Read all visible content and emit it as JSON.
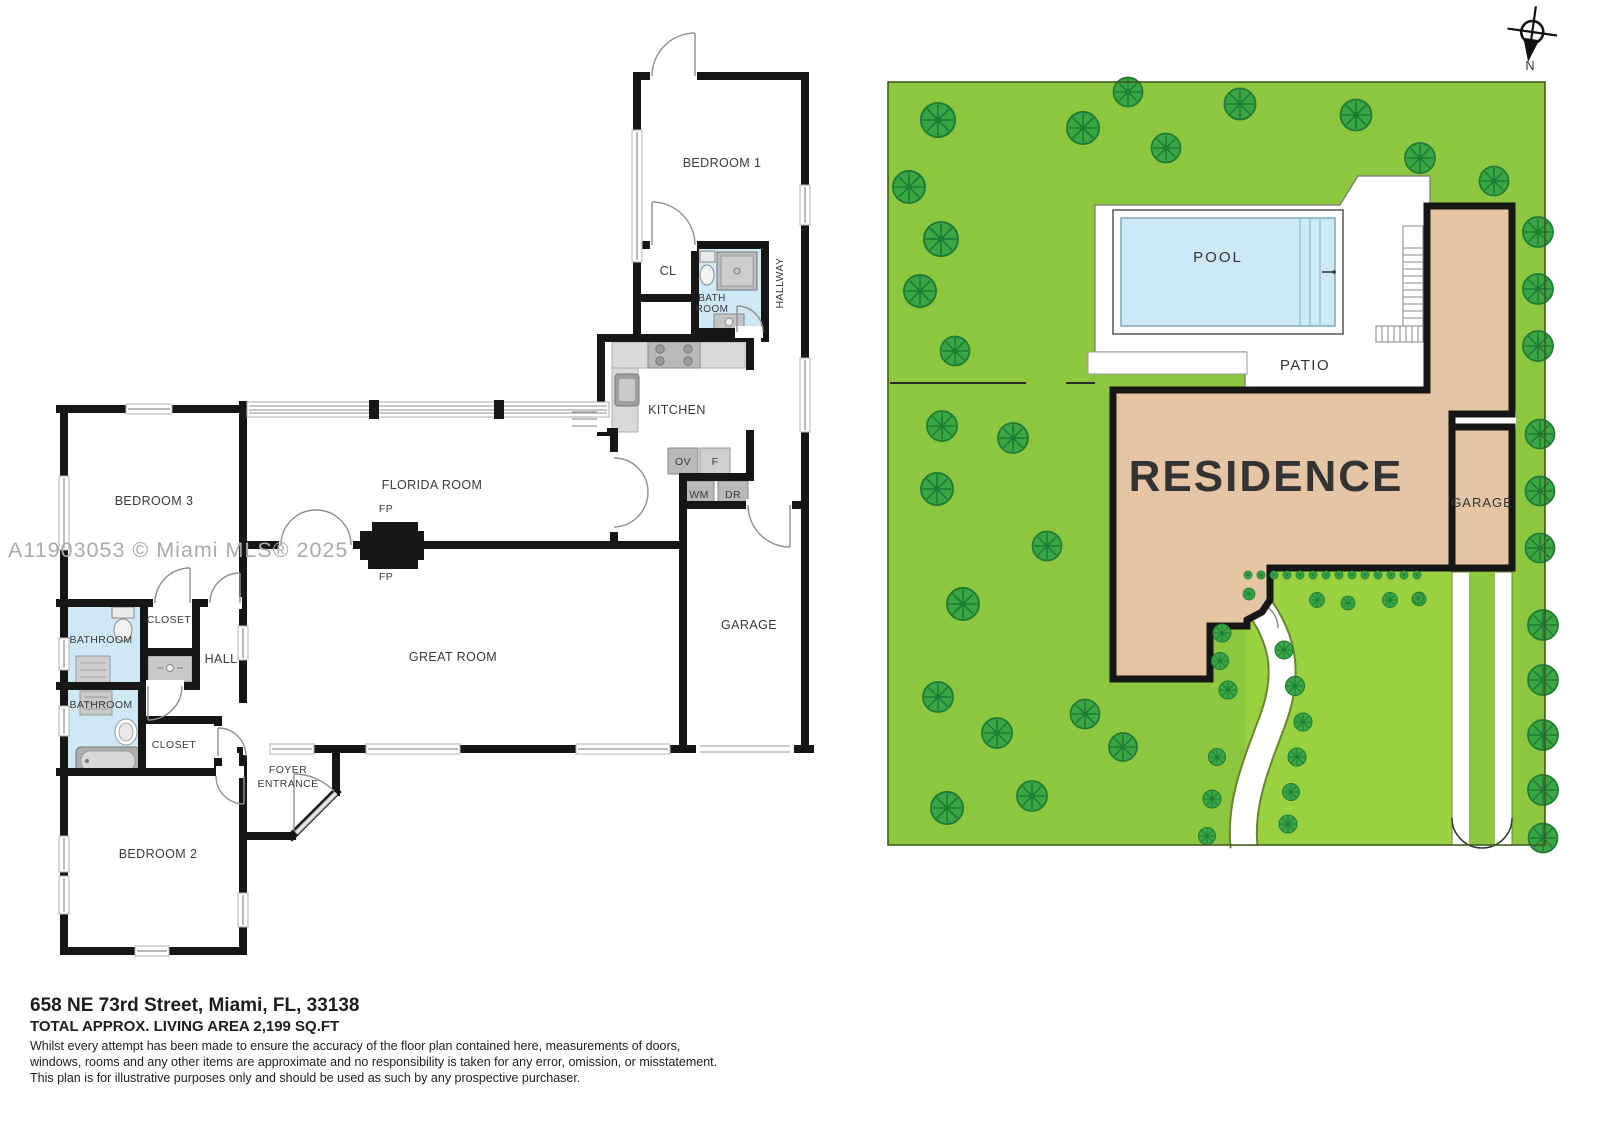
{
  "watermark": "A11903053 © Miami MLS® 2025",
  "compass_label": "N",
  "floor_plan": {
    "bedroom1": "BEDROOM 1",
    "cl": "CL",
    "bath_line1": "BATH",
    "bath_line2": "ROOM",
    "hallway": "HALLWAY",
    "kitchen": "KITCHEN",
    "ov": "OV",
    "fridge": "F",
    "wm": "WM",
    "dr": "DR",
    "florida_room": "FLORIDA ROOM",
    "fp": "FP",
    "bedroom3": "BEDROOM 3",
    "bathroom_top": "BATHROOM",
    "closet_top": "CLOSET",
    "hall": "HALL",
    "bathroom_bottom": "BATHROOM",
    "closet_bottom": "CLOSET",
    "great_room": "GREAT ROOM",
    "garage": "GARAGE",
    "foyer_line1": "FOYER",
    "foyer_line2": "ENTRANCE",
    "bedroom2": "BEDROOM 2"
  },
  "site_plan": {
    "pool": "POOL",
    "patio": "PATIO",
    "residence": "RESIDENCE",
    "garage": "GARAGE",
    "colors": {
      "lawn": "#8dc63f",
      "lawn_light": "#9ad141",
      "tree": "#3aa644",
      "tree_dark": "#1e7c35",
      "residence_fill": "#e5c5a3",
      "pool_water": "#cde9f8",
      "wall_black": "#161616"
    },
    "trees": [
      [
        938,
        120,
        1.7
      ],
      [
        1083,
        128,
        1.6
      ],
      [
        1128,
        92,
        1.45
      ],
      [
        1240,
        104,
        1.55
      ],
      [
        1356,
        115,
        1.55
      ],
      [
        1166,
        148,
        1.45
      ],
      [
        1420,
        158,
        1.5
      ],
      [
        1494,
        181,
        1.45
      ],
      [
        909,
        187,
        1.6
      ],
      [
        941,
        239,
        1.7
      ],
      [
        920,
        291,
        1.6
      ],
      [
        955,
        351,
        1.45
      ],
      [
        942,
        426,
        1.5
      ],
      [
        1013,
        438,
        1.5
      ],
      [
        937,
        489,
        1.6
      ],
      [
        1047,
        546,
        1.45
      ],
      [
        963,
        604,
        1.6
      ],
      [
        938,
        697,
        1.5
      ],
      [
        997,
        733,
        1.5
      ],
      [
        947,
        808,
        1.6
      ],
      [
        1032,
        796,
        1.5
      ],
      [
        1085,
        714,
        1.45
      ],
      [
        1123,
        747,
        1.4
      ],
      [
        1538,
        232,
        1.5
      ],
      [
        1538,
        289,
        1.5
      ],
      [
        1538,
        346,
        1.5
      ],
      [
        1540,
        434,
        1.45
      ],
      [
        1540,
        491,
        1.45
      ],
      [
        1540,
        548,
        1.45
      ],
      [
        1543,
        625,
        1.5
      ],
      [
        1543,
        680,
        1.5
      ],
      [
        1543,
        735,
        1.5
      ],
      [
        1543,
        790,
        1.5
      ],
      [
        1543,
        838,
        1.45
      ]
    ],
    "path_bushes": [
      [
        1222,
        633,
        0.9
      ],
      [
        1220,
        661,
        0.85
      ],
      [
        1228,
        690,
        0.9
      ],
      [
        1217,
        757,
        0.85
      ],
      [
        1212,
        799,
        0.9
      ],
      [
        1207,
        836,
        0.85
      ],
      [
        1284,
        650,
        0.9
      ],
      [
        1295,
        686,
        0.95
      ],
      [
        1303,
        722,
        0.9
      ],
      [
        1297,
        757,
        0.9
      ],
      [
        1291,
        792,
        0.85
      ],
      [
        1288,
        824,
        0.9
      ],
      [
        1317,
        600,
        0.75
      ],
      [
        1348,
        603,
        0.7
      ],
      [
        1390,
        600,
        0.75
      ],
      [
        1419,
        599,
        0.7
      ],
      [
        1418,
        598,
        0.55
      ],
      [
        1249,
        594,
        0.6
      ]
    ],
    "hedge": {
      "x_start": 1248,
      "x_end": 1424,
      "step": 13,
      "y": 575,
      "scale": 0.42
    }
  },
  "footer": {
    "address": "658 NE 73rd Street, Miami, FL, 33138",
    "area": "TOTAL APPROX. LIVING AREA 2,199 SQ.FT",
    "disclaimer": [
      "Whilst every attempt has been made to ensure the accuracy of the floor plan contained here, measurements of doors,",
      "windows, rooms and any other items are approximate and no responsibility is taken for any error, omission, or misstatement.",
      "This plan is for illustrative purposes only and should be used as such by any prospective purchaser."
    ]
  }
}
